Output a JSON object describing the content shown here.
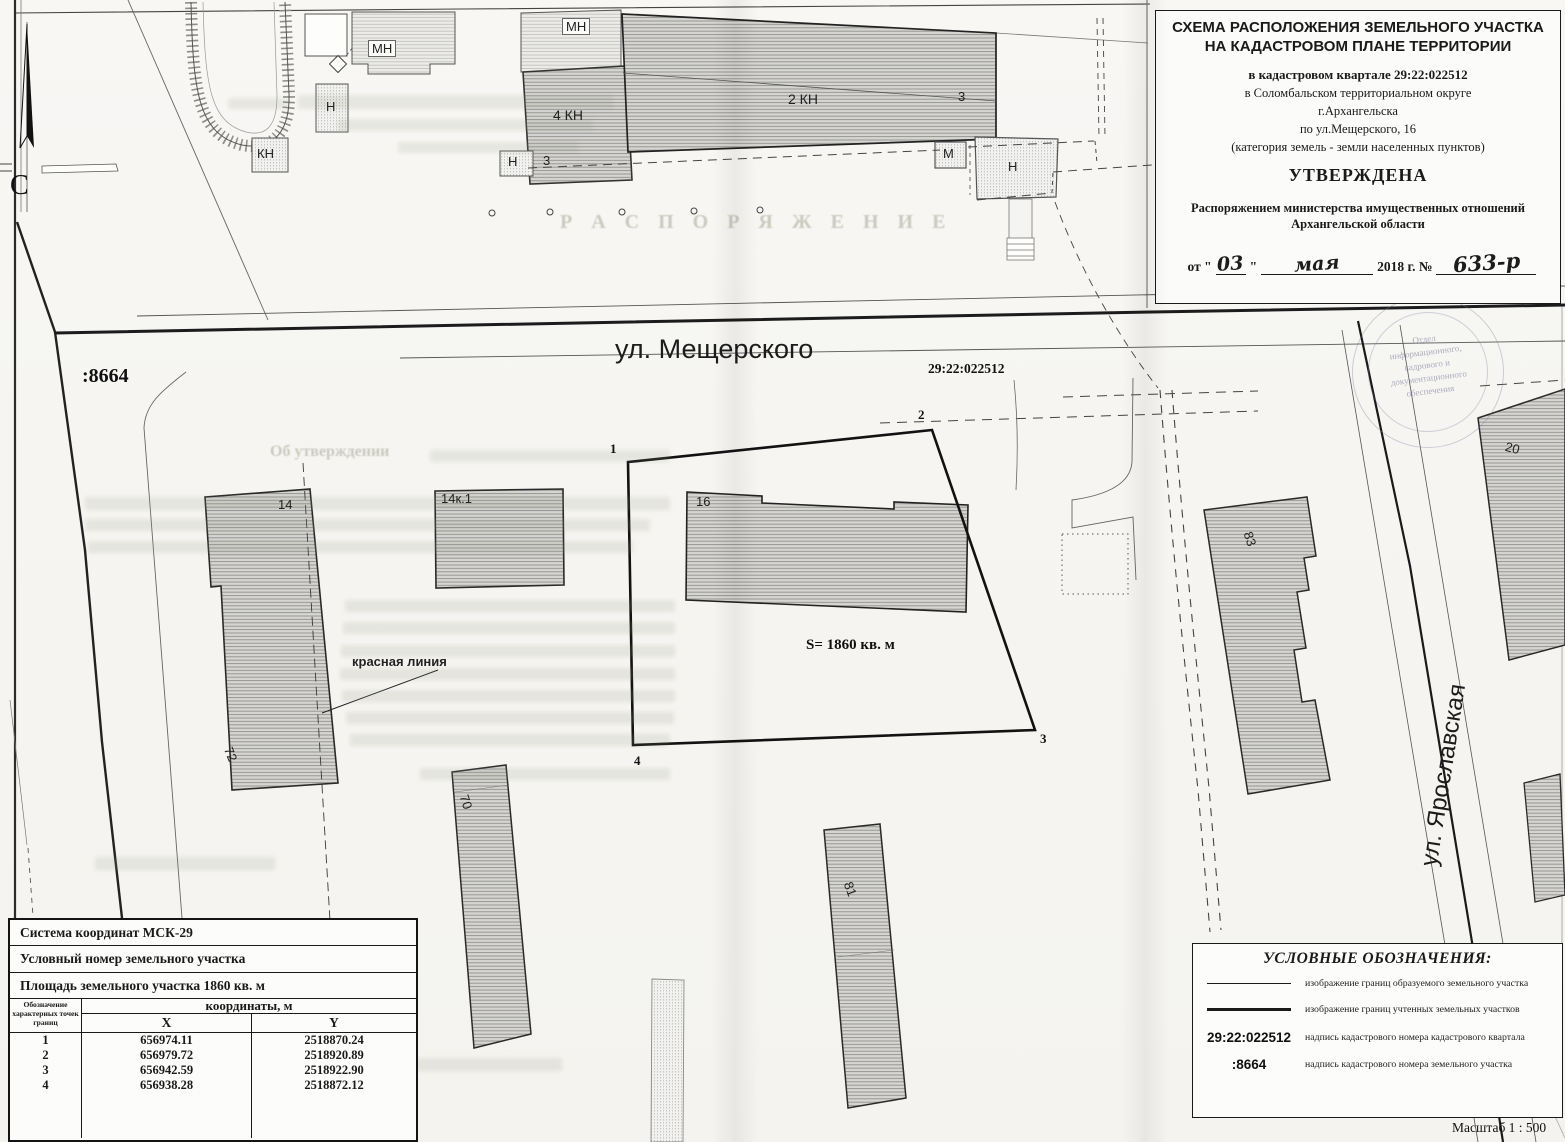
{
  "title_block": {
    "heading1": "СХЕМА РАСПОЛОЖЕНИЯ ЗЕМЕЛЬНОГО УЧАСТКА",
    "heading2": "НА КАДАСТРОВОМ ПЛАНЕ ТЕРРИТОРИИ",
    "quarter_line": "в кадастровом квартале 29:22:022512",
    "district_line": "в  Соломбальском территориальном округе",
    "city_line": "г.Архангельска",
    "address_line": "по ул.Мещерского, 16",
    "category_line": "(категория земель - земли населенных пунктов)",
    "approved_label": "УТВЕРЖДЕНА",
    "order_line1": "Распоряжением министерства имущественных отношений",
    "order_line2": "Архангельской области",
    "date_from": "от \"",
    "date_day": "03",
    "date_close_quote": "\"",
    "date_month_hand": "мая",
    "date_year": "2018 г. №",
    "order_number_hand": "633-р"
  },
  "map": {
    "north_label": "С",
    "street_main": "ул. Мещерского",
    "street_side": "ул. Ярославская",
    "quarter_number": "29:22:022512",
    "parcel_number": ":8664",
    "area_label": "S= 1860 кв. м",
    "red_line_label": "красная линия",
    "points": {
      "p1": "1",
      "p2": "2",
      "p3": "3",
      "p4": "4"
    },
    "buildings": {
      "b14": "14",
      "b72": "72",
      "b14k1": "14к.1",
      "b16": "16",
      "b70": "70",
      "b81": "81",
      "b83": "83",
      "b20": "20",
      "kn2": "2 КН",
      "kn4": "4 КН",
      "mn1": "МН",
      "mn2": "МН",
      "n1": "Н",
      "n2": "Н",
      "n3": "Н",
      "kn": "КН",
      "m": "М",
      "d3a": "3",
      "d3b": "3"
    }
  },
  "coords_table": {
    "row_system": "Система координат МСК-29",
    "row_number": "Условный номер земельного участка",
    "row_area": "Площадь земельного участка  1860 кв. м",
    "col_points_header": "Обозначение характерных точек границ",
    "col_coords_header": "координаты, м",
    "col_x": "X",
    "col_y": "Y",
    "points": [
      {
        "n": "1",
        "x": "656974.11",
        "y": "2518870.24"
      },
      {
        "n": "2",
        "x": "656979.72",
        "y": "2518920.89"
      },
      {
        "n": "3",
        "x": "656942.59",
        "y": "2518922.90"
      },
      {
        "n": "4",
        "x": "656938.28",
        "y": "2518872.12"
      }
    ]
  },
  "legend": {
    "title": "УСЛОВНЫЕ ОБОЗНАЧЕНИЯ:",
    "items": [
      {
        "symbol": "",
        "text": "изображение границ образуемого земельного участка"
      },
      {
        "symbol": "",
        "text": "изображение границ учтенных земельных участков"
      },
      {
        "symbol": "29:22:022512",
        "text": "надпись кадастрового номера кадастрового квартала"
      },
      {
        "symbol": ":8664",
        "text": "надпись кадастрового номера земельного участка"
      }
    ],
    "scale": "Масштаб  1 : 500"
  },
  "stamp": {
    "lines": [
      "Отдел",
      "информационного,",
      "кадрового и",
      "документационного",
      "обеспечения"
    ]
  },
  "ghost": {
    "order_word": "Р А С П О Р Я Ж Е Н И Е",
    "approval_fragment": "Об утверждении"
  }
}
